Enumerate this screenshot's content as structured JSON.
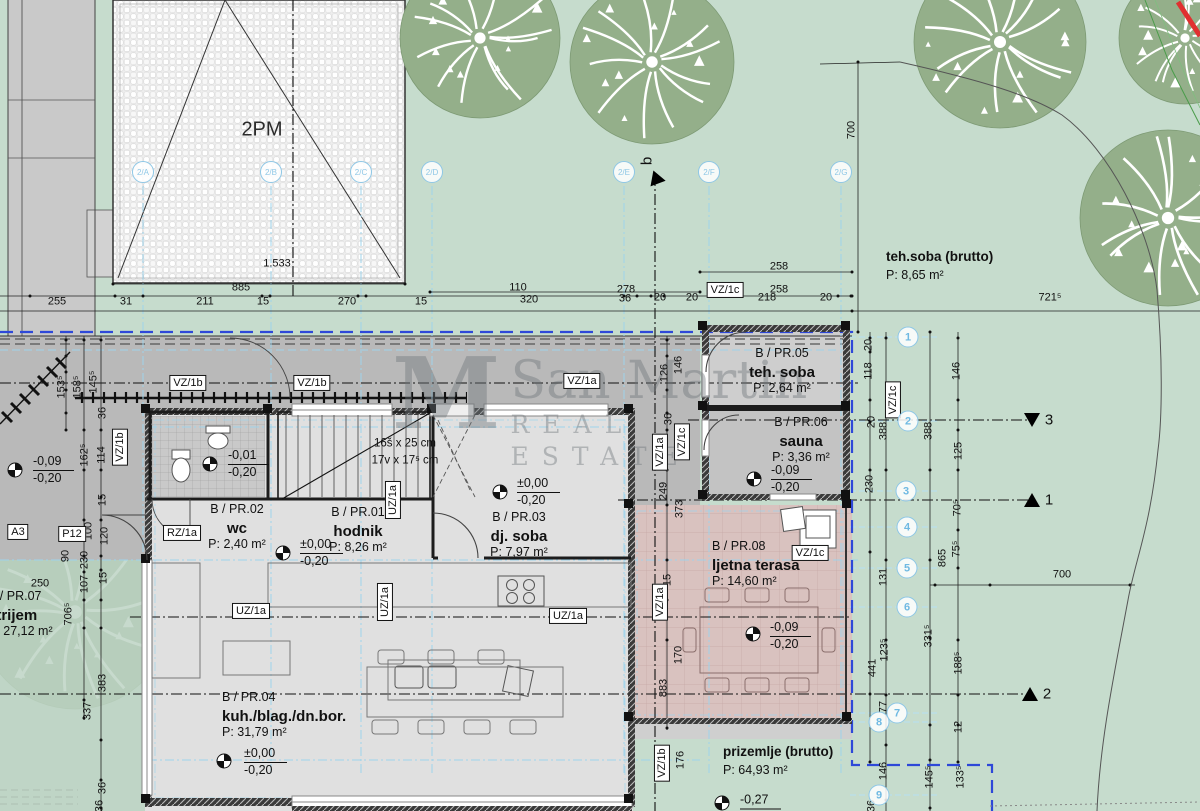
{
  "colors": {
    "lawn": "#c6dccd",
    "atrium_green": "#bdd4c4",
    "road": "#c9c9c9",
    "driveway": "#b9b9b9",
    "floor": "#e0e0e0",
    "wc_floor": "#c9c9c9",
    "teh_floor": "#cecece",
    "sauna_floor": "#c3c3c3",
    "terrace": "#d9c2bf",
    "wall": "#1c1c1c",
    "boundary_blue": "#2e48d8",
    "axis_cyan": "#9ed3eb",
    "marker_blue": "#8ec7e6",
    "tree": "#94af8a",
    "red_mark": "#e03030"
  },
  "watermark": {
    "monogram": "M",
    "line1": "San Martin",
    "line2": "REAL ESTATE"
  },
  "parking": {
    "label": "2PM"
  },
  "stairs": {
    "l1": "16š x 25 cm",
    "l2": "17v x 17⁵ cm",
    "x": 405,
    "y": 452
  },
  "rooms": [
    {
      "code": "B / PR.01",
      "name": "hodnik",
      "area": "P: 8,26 m²",
      "x": 358,
      "y": 506,
      "align": "c"
    },
    {
      "code": "B / PR.02",
      "name": "wc",
      "area": "P: 2,40 m²",
      "x": 237,
      "y": 503,
      "align": "c"
    },
    {
      "code": "B / PR.03",
      "name": "dj. soba",
      "area": "P: 7,97 m²",
      "x": 519,
      "y": 511,
      "align": "c"
    },
    {
      "code": "B / PR.04",
      "name": "kuh./blag./dn.bor.",
      "area": "P: 31,79 m²",
      "x": 222,
      "y": 691,
      "align": "l"
    },
    {
      "code": "B / PR.05",
      "name": "teh. soba",
      "area": "P: 2,64 m²",
      "x": 782,
      "y": 347,
      "align": "c"
    },
    {
      "code": "B / PR.06",
      "name": "sauna",
      "area": "P: 3,36 m²",
      "x": 801,
      "y": 416,
      "align": "c"
    },
    {
      "code": "B / PR.07",
      "name": "atrijem",
      "area": "P: 27,12 m²",
      "x": -12,
      "y": 590,
      "align": "l"
    },
    {
      "code": "B / PR.08",
      "name": "ljetna terasa",
      "area": "P: 14,60 m²",
      "x": 712,
      "y": 540,
      "align": "l"
    }
  ],
  "site_labels": [
    {
      "name": "teh.soba (brutto)",
      "area": "P: 8,65 m²",
      "x": 886,
      "y": 250
    },
    {
      "name": "prizemlje (brutto)",
      "area": "P: 64,93 m²",
      "x": 723,
      "y": 745
    }
  ],
  "levels": [
    {
      "l1": "±0,00",
      "l2": "-0,20",
      "sx": 283,
      "sy": 553,
      "tx": 300,
      "ty": 553
    },
    {
      "l1": "±0,00",
      "l2": "-0,20",
      "sx": 500,
      "sy": 492,
      "tx": 517,
      "ty": 492
    },
    {
      "l1": "±0,00",
      "l2": "-0,20",
      "sx": 224,
      "sy": 761,
      "tx": 244,
      "ty": 762
    },
    {
      "l1": "-0,01",
      "l2": "-0,20",
      "sx": 210,
      "sy": 464,
      "tx": 228,
      "ty": 464
    },
    {
      "l1": "-0,09",
      "l2": "-0,20",
      "sx": 15,
      "sy": 470,
      "tx": 33,
      "ty": 470
    },
    {
      "l1": "-0,09",
      "l2": "-0,20",
      "sx": 754,
      "sy": 479,
      "tx": 771,
      "ty": 479
    },
    {
      "l1": "-0,09",
      "l2": "-0,20",
      "sx": 753,
      "sy": 634,
      "tx": 770,
      "ty": 636
    },
    {
      "l1": "-0,27",
      "l2": "",
      "sx": 722,
      "sy": 803,
      "tx": 740,
      "ty": 801
    }
  ],
  "dims": [
    {
      "t": "255",
      "x": 57,
      "y": 302
    },
    {
      "t": "31",
      "x": 126,
      "y": 302
    },
    {
      "t": "211",
      "x": 205,
      "y": 302
    },
    {
      "t": "15",
      "x": 263,
      "y": 302
    },
    {
      "t": "270",
      "x": 347,
      "y": 302
    },
    {
      "t": "15",
      "x": 421,
      "y": 302
    },
    {
      "t": "320",
      "x": 529,
      "y": 300
    },
    {
      "t": "36",
      "x": 625,
      "y": 299
    },
    {
      "t": "20",
      "x": 660,
      "y": 298
    },
    {
      "t": "20",
      "x": 692,
      "y": 298
    },
    {
      "t": "218",
      "x": 767,
      "y": 298
    },
    {
      "t": "20",
      "x": 826,
      "y": 298
    },
    {
      "t": "885",
      "x": 241,
      "y": 288
    },
    {
      "t": "110",
      "x": 518,
      "y": 288
    },
    {
      "t": "278",
      "x": 626,
      "y": 290
    },
    {
      "t": "258",
      "x": 779,
      "y": 267
    },
    {
      "t": "258",
      "x": 779,
      "y": 290
    },
    {
      "t": "1.533",
      "x": 277,
      "y": 264
    },
    {
      "t": "721⁵",
      "x": 1050,
      "y": 298
    },
    {
      "t": "153⁵",
      "x": 62,
      "y": 387,
      "r": 1
    },
    {
      "t": "158⁵",
      "x": 78,
      "y": 387,
      "r": 1
    },
    {
      "t": "145⁵",
      "x": 94,
      "y": 382,
      "r": 1
    },
    {
      "t": "36",
      "x": 103,
      "y": 413,
      "r": 1
    },
    {
      "t": "162⁵",
      "x": 85,
      "y": 455,
      "r": 1
    },
    {
      "t": "114",
      "x": 102,
      "y": 455,
      "r": 1
    },
    {
      "t": "15",
      "x": 103,
      "y": 500,
      "r": 1
    },
    {
      "t": "100",
      "x": 89,
      "y": 531,
      "r": 1
    },
    {
      "t": "120",
      "x": 105,
      "y": 536,
      "r": 1
    },
    {
      "t": "90",
      "x": 66,
      "y": 556,
      "r": 1
    },
    {
      "t": "230",
      "x": 85,
      "y": 560,
      "r": 1
    },
    {
      "t": "107",
      "x": 85,
      "y": 584,
      "r": 1
    },
    {
      "t": "15",
      "x": 104,
      "y": 578,
      "r": 1
    },
    {
      "t": "706⁵",
      "x": 69,
      "y": 614,
      "r": 1
    },
    {
      "t": "250",
      "x": 40,
      "y": 584
    },
    {
      "t": "383",
      "x": 103,
      "y": 683,
      "r": 1
    },
    {
      "t": "337",
      "x": 88,
      "y": 711,
      "r": 1
    },
    {
      "t": "36",
      "x": 103,
      "y": 788,
      "r": 1
    },
    {
      "t": "249",
      "x": 664,
      "y": 491,
      "r": 1
    },
    {
      "t": "373",
      "x": 680,
      "y": 509,
      "r": 1
    },
    {
      "t": "126",
      "x": 665,
      "y": 373,
      "r": 1
    },
    {
      "t": "146",
      "x": 679,
      "y": 365,
      "r": 1
    },
    {
      "t": "36",
      "x": 669,
      "y": 419,
      "r": 1
    },
    {
      "t": "15",
      "x": 668,
      "y": 580,
      "r": 1
    },
    {
      "t": "170",
      "x": 679,
      "y": 655,
      "r": 1
    },
    {
      "t": "883",
      "x": 664,
      "y": 688,
      "r": 1
    },
    {
      "t": "176",
      "x": 681,
      "y": 760,
      "r": 1
    },
    {
      "t": "36",
      "x": 100,
      "y": 806,
      "r": 1
    },
    {
      "t": "36",
      "x": 872,
      "y": 806,
      "r": 1
    },
    {
      "t": "20",
      "x": 869,
      "y": 345,
      "r": 1
    },
    {
      "t": "118",
      "x": 869,
      "y": 371,
      "r": 1
    },
    {
      "t": "20",
      "x": 872,
      "y": 422,
      "r": 1
    },
    {
      "t": "388",
      "x": 884,
      "y": 431,
      "r": 1
    },
    {
      "t": "388",
      "x": 929,
      "y": 431,
      "r": 1
    },
    {
      "t": "146",
      "x": 957,
      "y": 371,
      "r": 1
    },
    {
      "t": "230",
      "x": 870,
      "y": 484,
      "r": 1
    },
    {
      "t": "125",
      "x": 959,
      "y": 451,
      "r": 1
    },
    {
      "t": "70⁵",
      "x": 958,
      "y": 508,
      "r": 1
    },
    {
      "t": "75⁵",
      "x": 957,
      "y": 549,
      "r": 1
    },
    {
      "t": "865",
      "x": 943,
      "y": 558,
      "r": 1
    },
    {
      "t": "131",
      "x": 884,
      "y": 577,
      "r": 1
    },
    {
      "t": "123⁵",
      "x": 885,
      "y": 650,
      "r": 1
    },
    {
      "t": "331⁵",
      "x": 929,
      "y": 636,
      "r": 1
    },
    {
      "t": "441",
      "x": 873,
      "y": 668,
      "r": 1
    },
    {
      "t": "188⁵",
      "x": 959,
      "y": 663,
      "r": 1
    },
    {
      "t": "77",
      "x": 884,
      "y": 707,
      "r": 1
    },
    {
      "t": "12",
      "x": 959,
      "y": 727,
      "r": 1
    },
    {
      "t": "146",
      "x": 884,
      "y": 771,
      "r": 1
    },
    {
      "t": "145⁵",
      "x": 930,
      "y": 777,
      "r": 1
    },
    {
      "t": "133⁵",
      "x": 961,
      "y": 777,
      "r": 1
    },
    {
      "t": "700",
      "x": 852,
      "y": 130,
      "r": 1
    },
    {
      "t": "700",
      "x": 1062,
      "y": 575
    }
  ],
  "tags": [
    {
      "t": "VZ/1b",
      "x": 188,
      "y": 383
    },
    {
      "t": "VZ/1b",
      "x": 312,
      "y": 383
    },
    {
      "t": "VZ/1a",
      "x": 582,
      "y": 381
    },
    {
      "t": "VZ/1c",
      "x": 725,
      "y": 290
    },
    {
      "t": "VZ/1c",
      "x": 810,
      "y": 553
    },
    {
      "t": "RZ/1a",
      "x": 182,
      "y": 533
    },
    {
      "t": "UZ/1a",
      "x": 251,
      "y": 611
    },
    {
      "t": "UZ/1a",
      "x": 568,
      "y": 616
    },
    {
      "t": "VZ/1b",
      "x": 120,
      "y": 447,
      "v": 1
    },
    {
      "t": "VZ/1b",
      "x": 662,
      "y": 763,
      "v": 1
    },
    {
      "t": "VZ/1c",
      "x": 893,
      "y": 400,
      "v": 1
    },
    {
      "t": "VZ/1c",
      "x": 682,
      "y": 442,
      "v": 1
    },
    {
      "t": "VZ/1a",
      "x": 660,
      "y": 452,
      "v": 1
    },
    {
      "t": "VZ/1a",
      "x": 660,
      "y": 602,
      "v": 1
    },
    {
      "t": "UZ/1a",
      "x": 385,
      "y": 602,
      "v": 1
    },
    {
      "t": "UZ/1a",
      "x": 393,
      "y": 500,
      "v": 1
    },
    {
      "t": "A3",
      "x": 18,
      "y": 532
    },
    {
      "t": "P12",
      "x": 72,
      "y": 534
    }
  ],
  "grid_top": {
    "y": 172,
    "items": [
      {
        "t": "2/A",
        "x": 143
      },
      {
        "t": "2/B",
        "x": 271
      },
      {
        "t": "2/C",
        "x": 361
      },
      {
        "t": "2/D",
        "x": 432
      },
      {
        "t": "2/E",
        "x": 624
      },
      {
        "t": "2/F",
        "x": 709
      },
      {
        "t": "2/G",
        "x": 841
      }
    ]
  },
  "axis_circles": [
    {
      "t": "1",
      "x": 908,
      "y": 337
    },
    {
      "t": "2",
      "x": 908,
      "y": 421
    },
    {
      "t": "3",
      "x": 906,
      "y": 491
    },
    {
      "t": "4",
      "x": 907,
      "y": 527
    },
    {
      "t": "5",
      "x": 907,
      "y": 568
    },
    {
      "t": "6",
      "x": 907,
      "y": 607
    },
    {
      "t": "7",
      "x": 897,
      "y": 713
    },
    {
      "t": "8",
      "x": 879,
      "y": 722
    },
    {
      "t": "9",
      "x": 879,
      "y": 795
    }
  ],
  "sections": [
    {
      "t": "b",
      "x": 647,
      "y": 161,
      "tx": 655,
      "ty": 181,
      "dir": "bl",
      "rot": 1
    },
    {
      "t": "3",
      "x": 1049,
      "y": 420,
      "tx": 1032,
      "ty": 420,
      "dir": "down"
    },
    {
      "t": "1",
      "x": 1049,
      "y": 500,
      "tx": 1032,
      "ty": 500,
      "dir": "up"
    },
    {
      "t": "2",
      "x": 1047,
      "y": 694,
      "tx": 1030,
      "ty": 694,
      "dir": "up"
    }
  ],
  "trees": [
    [
      480,
      38,
      80
    ],
    [
      652,
      62,
      82
    ],
    [
      1000,
      42,
      86
    ],
    [
      1185,
      38,
      66
    ],
    [
      1168,
      218,
      88
    ],
    [
      75,
      612,
      97
    ]
  ]
}
